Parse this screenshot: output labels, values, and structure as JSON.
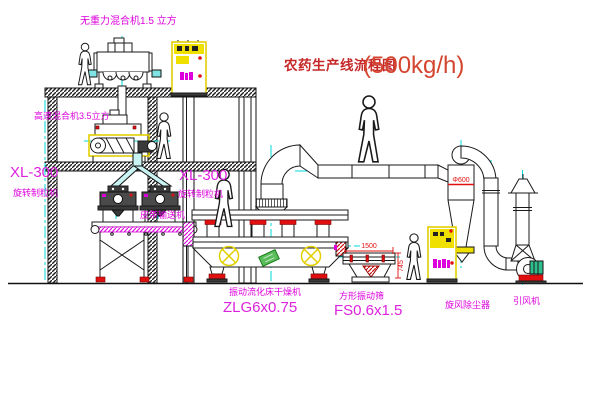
{
  "title": {
    "name_cn": "农药生产线流程图",
    "capacity": "(500kg/h)"
  },
  "equipment_labels": {
    "gravity_free_mixer": "无重力混合机1.5 立方",
    "high_speed_mixer": "高速混合机3.5立方",
    "granulator_left_model": "XL-300",
    "granulator_left_name": "旋转制粒机",
    "granulator_mid_model": "XL-300",
    "granulator_mid_name": "旋转制粒机",
    "belt_conveyor": "皮带输送机",
    "fluid_bed_dryer_name": "振动流化床干燥机",
    "fluid_bed_dryer_model": "ZLG6x0.75",
    "square_vibrating_sieve_name": "方形振动筛",
    "square_vibrating_sieve_model": "FS0.6x1.5",
    "cyclone_dust_collector": "旋风除尘器",
    "induced_draft_fan": "引风机"
  },
  "dimensions": {
    "sieve_length": "1500",
    "sieve_height": "745",
    "cyclone_diameter": "Φ600"
  },
  "colors": {
    "label_magenta": "#dd00dd",
    "title_red": "#c62828",
    "dimension_red": "#e01010",
    "centerline_cyan": "#00d8d8",
    "cabinet_yellow": "#f0e000",
    "motor_green": "#2fbf8f",
    "line_black": "#1a1a1a",
    "background": "#ffffff"
  }
}
